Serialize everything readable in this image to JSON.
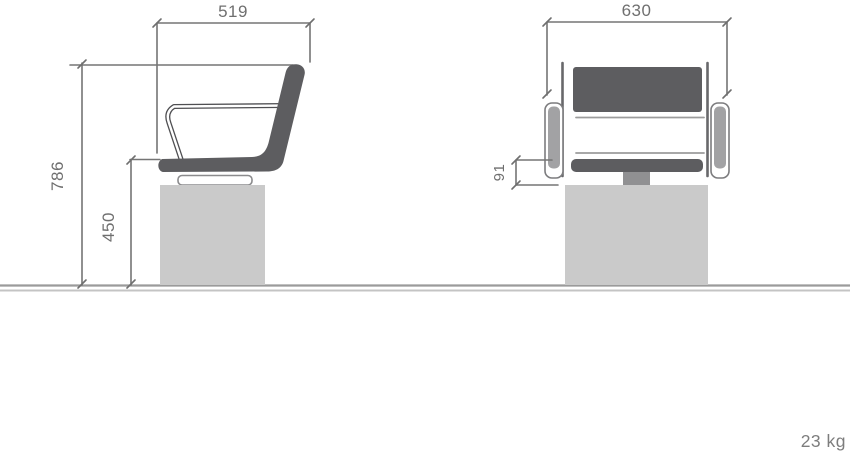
{
  "diagram": {
    "type": "product-dimension-drawing",
    "subject": "salon-backwash-chair",
    "views": [
      {
        "id": "side",
        "name": "side elevation"
      },
      {
        "id": "front",
        "name": "front elevation"
      }
    ]
  },
  "dims": {
    "side_width": "519",
    "overall_height": "786",
    "seat_height": "450",
    "front_width": "630",
    "seat_thickness": "91"
  },
  "weight_label": "23 kg",
  "colors": {
    "upholstery": "#5d5d60",
    "frame_outline": "#4f4f52",
    "base_fill": "#cacaca",
    "stem_fill": "#909092",
    "pad_inner": "#a2a2a4",
    "post_stroke": "#68686b",
    "dim_line": "#757575",
    "dim_text": "#6f6f6f",
    "ground_dark": "#9b9b9b",
    "ground_light": "#c4c4c4"
  }
}
